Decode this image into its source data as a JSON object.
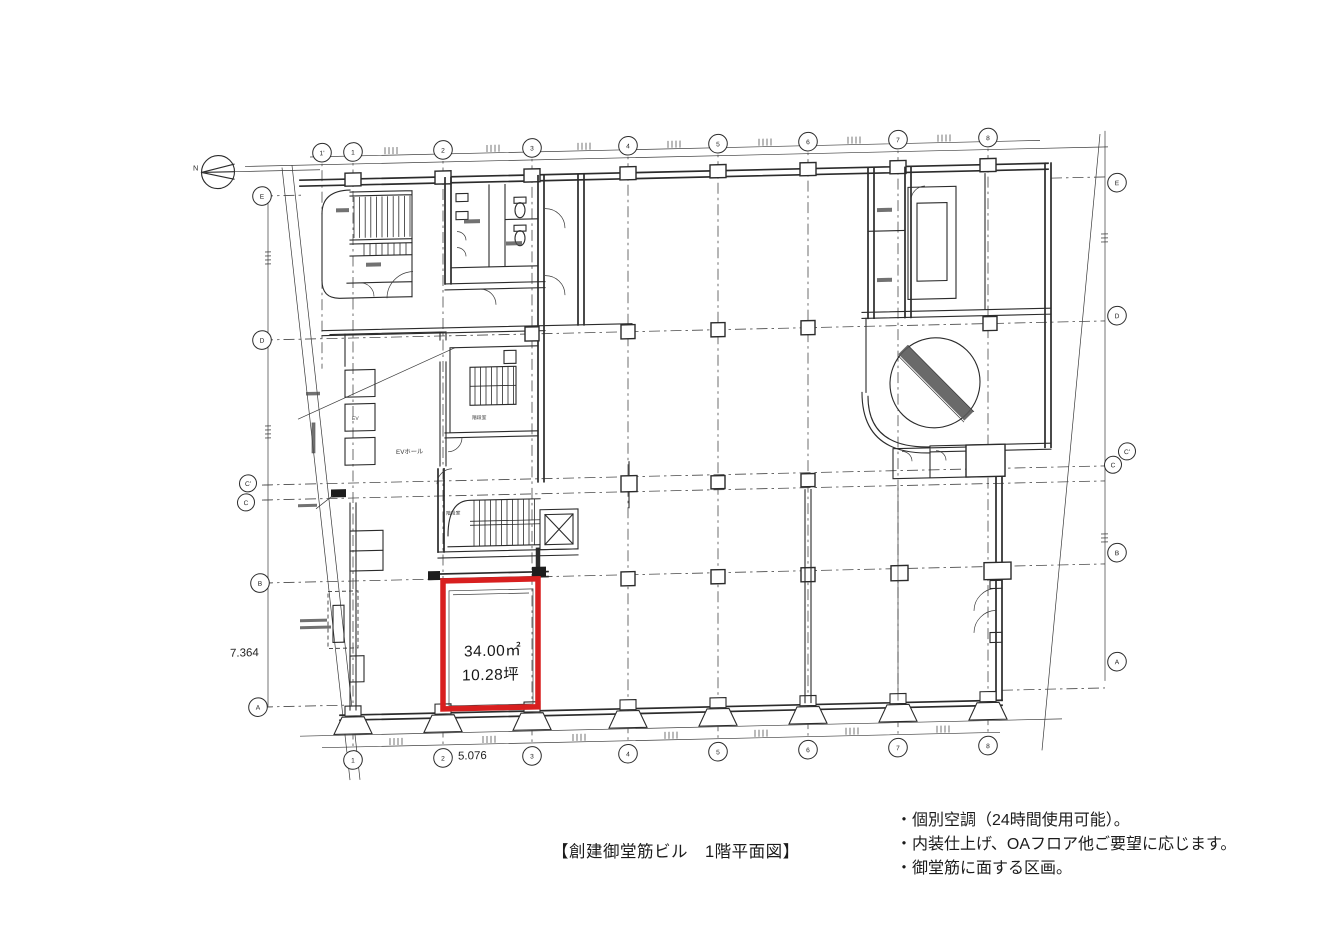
{
  "document": {
    "caption": "【創建御堂筋ビル　1階平面図】",
    "notes": [
      "・個別空調（24時間使用可能）。",
      "・内装仕上げ、OAフロア他ご要望に応じます。",
      "・御堂筋に面する区画。"
    ]
  },
  "highlight": {
    "area_sqm": "34.00㎡",
    "area_tsubo": "10.28坪",
    "color": "#d81f1f"
  },
  "dimensions": {
    "left_vertical": "7.364",
    "bottom_horizontal": "5.076"
  },
  "grid": {
    "top": [
      "1'",
      "1",
      "2",
      "3",
      "4",
      "5",
      "6",
      "7",
      "8"
    ],
    "bottom": [
      "1",
      "2",
      "3",
      "4",
      "5",
      "6",
      "7",
      "8"
    ],
    "left": [
      "E",
      "D",
      "C'",
      "C",
      "B",
      "A"
    ],
    "right": [
      "E",
      "D",
      "C'",
      "C",
      "B",
      "A"
    ]
  },
  "plan_labels": {
    "north": "N",
    "ev_hall": "EVホール",
    "elevator": "EV",
    "stair_upper": "階段室",
    "stair_lower": "階段室"
  }
}
